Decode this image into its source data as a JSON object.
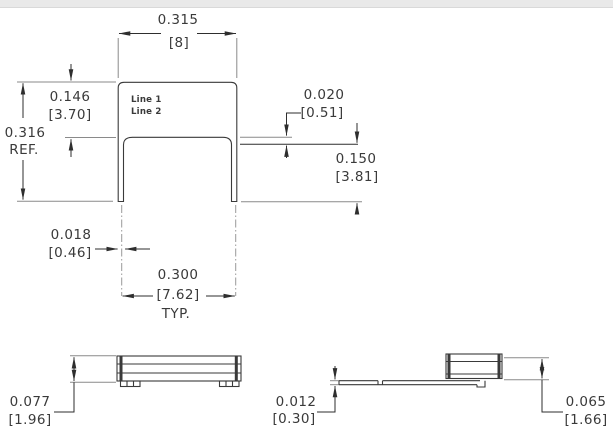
{
  "front_view": {
    "marking": {
      "line1": "Line 1",
      "line2": "Line 2"
    },
    "dim_width": {
      "inch": "0.315",
      "mm": "[8]"
    },
    "dim_body_height": {
      "inch": "0.146",
      "mm": "[3.70]"
    },
    "dim_overall_height": {
      "inch": "0.316",
      "suffix": "REF."
    },
    "dim_standoff": {
      "inch": "0.020",
      "mm": "[0.51]"
    },
    "dim_lead_length": {
      "inch": "0.150",
      "mm": "[3.81]"
    },
    "dim_lead_width": {
      "inch": "0.018",
      "mm": "[0.46]"
    },
    "dim_lead_spacing": {
      "inch": "0.300",
      "mm": "[7.62]",
      "suffix": "TYP."
    }
  },
  "side_view": {
    "dim_height": {
      "inch": "0.077",
      "mm": "[1.96]"
    }
  },
  "end_view": {
    "dim_lead_thickness": {
      "inch": "0.012",
      "mm": "[0.30]"
    },
    "dim_seated_height": {
      "inch": "0.065",
      "mm": "[1.66]"
    }
  },
  "colors": {
    "line": "#3a3a3a",
    "dimension": "#2e2e2e",
    "header_strip": "#e9e9e9"
  }
}
